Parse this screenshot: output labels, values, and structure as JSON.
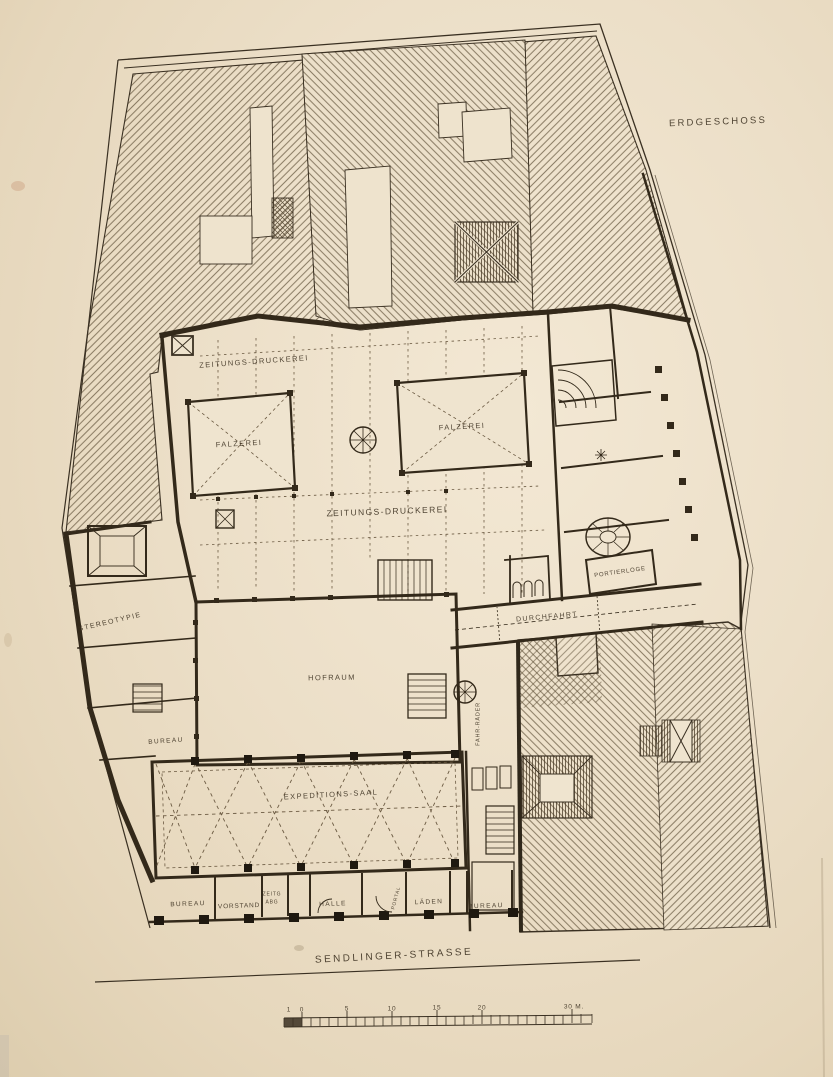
{
  "page": {
    "title": "ERDGESCHOSS",
    "street_label": "SENDLINGER-STRASSE"
  },
  "rooms": {
    "druckerei_north": "ZEITUNGS-DRUCKEREI",
    "druckerei_main": "ZEITUNGS-DRUCKEREI",
    "falzerei_west": "FALZEREI",
    "falzerei_east": "FALZEREI",
    "stereotypie": "STEREOTYPIE",
    "portierloge": "PORTIERLOGE",
    "durchfahrt": "DURCHFAHRT",
    "hofraum": "HOFRAUM",
    "bureau_west": "BUREAU",
    "fahrraeder": "FAHR-RÄDER",
    "expeditions_saal": "EXPEDITIONS-SAAL",
    "bureau_sw": "BUREAU",
    "vorstand": "VORSTAND",
    "zeitg_abg_line1": "ZEITG",
    "zeitg_abg_line2": "ABG",
    "halle": "HALLE",
    "portal": "PORTAL",
    "laeden": "LÄDEN",
    "bureau_se": "BUREAU"
  },
  "scale_bar": {
    "labels": [
      "1",
      "0",
      "5",
      "10",
      "15",
      "20",
      "30 M."
    ]
  },
  "colors": {
    "paper": "#ece0ca",
    "ink": "#352b1d",
    "hatch": "#57472f"
  }
}
